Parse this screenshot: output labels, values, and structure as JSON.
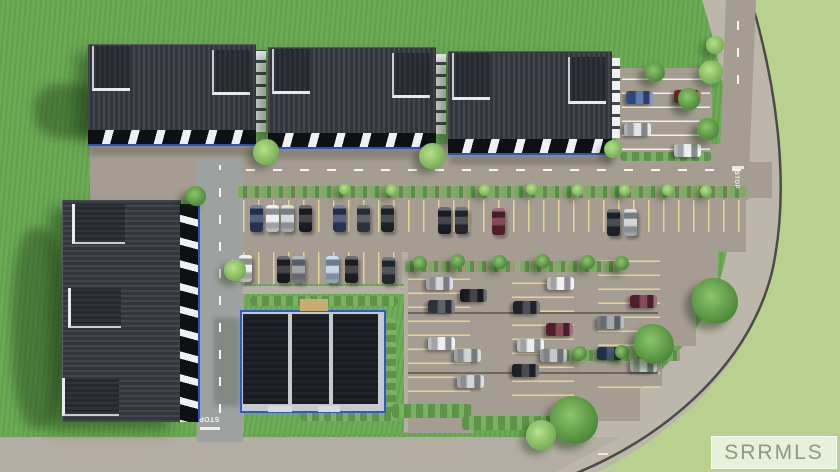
{
  "watermark": {
    "label": "SRRMLS"
  },
  "road_markings": {
    "stop_left": "STOP",
    "stop_right": "STOP"
  },
  "palette": {
    "grass_inner": "#6cab55",
    "grass_outer": "#b8d18f",
    "pavement": "#a69d92",
    "west_road": "#9da19f",
    "south_road": "#b3ada3",
    "perimeter_road": "#bdb6ab",
    "roof_dark": "#3a3e45",
    "panel_black": "#1a1c20",
    "trim_blue": "#3156d2",
    "stall_yellow": "#e4d896",
    "watermark_text": "#8f968c"
  },
  "scene": {
    "els": [
      {
        "n": "building-shadow",
        "c": "gshadow",
        "x": 34,
        "y": 84,
        "w": 70,
        "h": 54
      },
      {
        "n": "building-shadow",
        "c": "gshadow",
        "x": 12,
        "y": 228,
        "w": 54,
        "h": 200
      },
      {
        "n": "facade-shade",
        "c": "shade",
        "x": 90,
        "y": 146,
        "w": 168,
        "h": 10
      },
      {
        "n": "facade-shade",
        "c": "shade",
        "x": 270,
        "y": 149,
        "w": 166,
        "h": 10
      },
      {
        "n": "facade-shade",
        "c": "shade",
        "x": 450,
        "y": 155,
        "w": 162,
        "h": 10
      },
      {
        "n": "building-shade",
        "c": "shade",
        "x": 214,
        "y": 318,
        "w": 26,
        "h": 88
      },
      {
        "n": "stall-row-north",
        "c": "stallv",
        "x": 243,
        "y": 200,
        "w": 500,
        "h": 32
      },
      {
        "n": "stall-row-second",
        "c": "stallv",
        "x": 243,
        "y": 252,
        "w": 162,
        "h": 32
      },
      {
        "n": "stall-col-middle",
        "c": "stallh",
        "x": 408,
        "y": 274,
        "w": 62,
        "h": 118
      },
      {
        "n": "stall-col-middle",
        "c": "stallh",
        "x": 512,
        "y": 274,
        "w": 62,
        "h": 122
      },
      {
        "n": "stall-col-east",
        "c": "stallh",
        "x": 598,
        "y": 258,
        "w": 62,
        "h": 130
      },
      {
        "n": "stall-group-northeast",
        "c": "stallw",
        "x": 622,
        "y": 74,
        "w": 88,
        "h": 76
      },
      {
        "n": "aisle-dash-line",
        "c": "dashh",
        "x": 246,
        "y": 169,
        "w": 496,
        "h": 2
      },
      {
        "n": "west-road-dash-line",
        "c": "dashv",
        "x": 219,
        "y": 165,
        "w": 2,
        "h": 248
      },
      {
        "n": "north-road-dash-line",
        "c": "dashv",
        "x": 737,
        "y": 12,
        "w": 2,
        "h": 72
      },
      {
        "n": "stop-bar-west",
        "c": "box",
        "x": 200,
        "y": 427,
        "w": 20,
        "h": 3,
        "col": "#f0f0ec"
      },
      {
        "n": "stop-bar-north",
        "c": "box",
        "x": 732,
        "y": 166,
        "w": 12,
        "h": 3,
        "col": "#e9e9e4"
      },
      {
        "n": "lane-dot-south-road",
        "c": "box",
        "x": 598,
        "y": 453,
        "w": 10,
        "h": 2,
        "col": "#eceae2"
      },
      {
        "n": "curb-line",
        "c": "curb",
        "x": 408,
        "y": 312,
        "w": 250,
        "h": 2
      },
      {
        "n": "curb-line",
        "c": "curb",
        "x": 408,
        "y": 372,
        "w": 250,
        "h": 2
      },
      {
        "n": "walkway",
        "c": "walk",
        "x": 402,
        "y": 252,
        "w": 6,
        "h": 180
      },
      {
        "n": "planter-strip",
        "c": "strip",
        "x": 238,
        "y": 186,
        "w": 508,
        "h": 12
      },
      {
        "n": "planter-strip",
        "c": "strip",
        "x": 405,
        "y": 261,
        "w": 110,
        "h": 11
      },
      {
        "n": "planter-strip",
        "c": "strip",
        "x": 520,
        "y": 261,
        "w": 100,
        "h": 11
      },
      {
        "n": "planter-strip",
        "c": "strip",
        "x": 560,
        "y": 350,
        "w": 120,
        "h": 11
      },
      {
        "n": "planter-strip",
        "c": "shrub",
        "x": 620,
        "y": 152,
        "w": 92,
        "h": 9
      },
      {
        "n": "lawn-island",
        "c": "island",
        "x": 244,
        "y": 284,
        "w": 160,
        "h": 150
      },
      {
        "n": "walkway",
        "c": "walk",
        "x": 243,
        "y": 286,
        "w": 162,
        "h": 8
      },
      {
        "n": "shrub-row",
        "c": "shrub",
        "x": 250,
        "y": 296,
        "w": 148,
        "h": 10
      },
      {
        "n": "shrub-column",
        "c": "shrubv",
        "x": 382,
        "y": 318,
        "w": 14,
        "h": 96
      },
      {
        "n": "shrub-row",
        "c": "shrub",
        "x": 300,
        "y": 412,
        "w": 96,
        "h": 9
      },
      {
        "n": "shrub-row",
        "c": "shrub",
        "x": 392,
        "y": 404,
        "w": 80,
        "h": 14
      },
      {
        "n": "shrub-row",
        "c": "shrub",
        "x": 462,
        "y": 416,
        "w": 100,
        "h": 14
      },
      {
        "n": "clubhouse-base",
        "c": "trim",
        "x": 240,
        "y": 310,
        "w": 142,
        "h": 99
      },
      {
        "n": "clubhouse-roof-panel",
        "c": "panel",
        "x": 243,
        "y": 314,
        "w": 45,
        "h": 90
      },
      {
        "n": "clubhouse-roof-panel",
        "c": "panel",
        "x": 292,
        "y": 314,
        "w": 37,
        "h": 90
      },
      {
        "n": "clubhouse-roof-panel",
        "c": "panel",
        "x": 333,
        "y": 314,
        "w": 45,
        "h": 90
      },
      {
        "n": "clubhouse-entry",
        "c": "box",
        "x": 300,
        "y": 299,
        "w": 28,
        "h": 12,
        "col": "#c6ae72"
      },
      {
        "n": "clubhouse-step",
        "c": "box",
        "x": 268,
        "y": 406,
        "w": 24,
        "h": 6,
        "col": "#d9dbdd"
      },
      {
        "n": "clubhouse-step",
        "c": "box",
        "x": 318,
        "y": 406,
        "w": 22,
        "h": 6,
        "col": "#d9dbdd"
      },
      {
        "n": "rowhouse-roof-1",
        "c": "roofh",
        "x": 88,
        "y": 44,
        "w": 168,
        "h": 86
      },
      {
        "n": "rowhouse-facade-1",
        "c": "facadeh",
        "x": 88,
        "y": 130,
        "w": 168,
        "h": 14
      },
      {
        "n": "dormer",
        "c": "dormh",
        "x": 92,
        "y": 46,
        "w": 36,
        "h": 42
      },
      {
        "n": "dormer",
        "c": "dormh",
        "x": 212,
        "y": 50,
        "w": 36,
        "h": 42
      },
      {
        "n": "end-wall",
        "c": "endwall",
        "x": 256,
        "y": 50,
        "w": 10,
        "h": 82
      },
      {
        "n": "rowhouse-roof-2",
        "c": "roofh",
        "x": 268,
        "y": 47,
        "w": 168,
        "h": 86
      },
      {
        "n": "rowhouse-facade-2",
        "c": "facadeh",
        "x": 268,
        "y": 133,
        "w": 168,
        "h": 14
      },
      {
        "n": "dormer",
        "c": "dormh",
        "x": 272,
        "y": 49,
        "w": 36,
        "h": 42
      },
      {
        "n": "dormer",
        "c": "dormh",
        "x": 392,
        "y": 53,
        "w": 36,
        "h": 42
      },
      {
        "n": "end-wall",
        "c": "endwall",
        "x": 436,
        "y": 54,
        "w": 10,
        "h": 80
      },
      {
        "n": "rowhouse-roof-3",
        "c": "roofh",
        "x": 448,
        "y": 51,
        "w": 164,
        "h": 88
      },
      {
        "n": "rowhouse-facade-3",
        "c": "facadeh",
        "x": 448,
        "y": 139,
        "w": 164,
        "h": 14
      },
      {
        "n": "dormer",
        "c": "dormh",
        "x": 452,
        "y": 53,
        "w": 36,
        "h": 44
      },
      {
        "n": "dormer",
        "c": "dormh",
        "x": 568,
        "y": 57,
        "w": 36,
        "h": 44
      },
      {
        "n": "end-wall",
        "c": "endwall",
        "x": 612,
        "y": 58,
        "w": 8,
        "h": 80
      },
      {
        "n": "rowhouse-roof-west",
        "c": "roofv",
        "x": 62,
        "y": 200,
        "w": 118,
        "h": 222
      },
      {
        "n": "rowhouse-facade-west",
        "c": "facadev",
        "x": 180,
        "y": 204,
        "w": 18,
        "h": 218
      },
      {
        "n": "dormer",
        "c": "dormv",
        "x": 72,
        "y": 204,
        "w": 50,
        "h": 38
      },
      {
        "n": "dormer",
        "c": "dormv",
        "x": 68,
        "y": 288,
        "w": 50,
        "h": 38
      },
      {
        "n": "dormer",
        "c": "dormv",
        "x": 62,
        "y": 378,
        "w": 54,
        "h": 36
      },
      {
        "n": "parked-car",
        "c": "car",
        "x": 250,
        "y": 205,
        "w": 13,
        "h": 27,
        "col": "#2e3f66"
      },
      {
        "n": "parked-car",
        "c": "car",
        "x": 266,
        "y": 205,
        "w": 13,
        "h": 27,
        "col": "#e9eaeb"
      },
      {
        "n": "parked-car",
        "c": "car",
        "x": 281,
        "y": 205,
        "w": 13,
        "h": 27,
        "col": "#ccd0d2"
      },
      {
        "n": "parked-car",
        "c": "car",
        "x": 299,
        "y": 205,
        "w": 13,
        "h": 27,
        "col": "#1c1e22"
      },
      {
        "n": "parked-car",
        "c": "car",
        "x": 333,
        "y": 205,
        "w": 13,
        "h": 27,
        "col": "#31406b"
      },
      {
        "n": "parked-car",
        "c": "car",
        "x": 357,
        "y": 205,
        "w": 13,
        "h": 27,
        "col": "#3a3e45"
      },
      {
        "n": "parked-car",
        "c": "car",
        "x": 381,
        "y": 205,
        "w": 13,
        "h": 27,
        "col": "#22252a"
      },
      {
        "n": "parked-car",
        "c": "car",
        "x": 438,
        "y": 207,
        "w": 13,
        "h": 27,
        "col": "#1c1f24"
      },
      {
        "n": "parked-car",
        "c": "car",
        "x": 455,
        "y": 207,
        "w": 13,
        "h": 27,
        "col": "#2a2d33"
      },
      {
        "n": "parked-car",
        "c": "car",
        "x": 492,
        "y": 208,
        "w": 13,
        "h": 27,
        "col": "#6b2330"
      },
      {
        "n": "parked-car",
        "c": "car",
        "x": 607,
        "y": 209,
        "w": 13,
        "h": 27,
        "col": "#23262b"
      },
      {
        "n": "parked-car",
        "c": "car",
        "x": 624,
        "y": 209,
        "w": 13,
        "h": 27,
        "col": "#c9cccd"
      },
      {
        "n": "parked-car",
        "c": "car",
        "x": 239,
        "y": 255,
        "w": 13,
        "h": 27,
        "col": "#e9eaeb"
      },
      {
        "n": "parked-car",
        "c": "car",
        "x": 277,
        "y": 256,
        "w": 13,
        "h": 27,
        "col": "#1b1d21"
      },
      {
        "n": "parked-car",
        "c": "car",
        "x": 292,
        "y": 256,
        "w": 13,
        "h": 27,
        "col": "#8e9296"
      },
      {
        "n": "parked-car",
        "c": "car",
        "x": 326,
        "y": 256,
        "w": 13,
        "h": 27,
        "col": "#b9cde2"
      },
      {
        "n": "parked-car",
        "c": "car",
        "x": 345,
        "y": 256,
        "w": 13,
        "h": 27,
        "col": "#1d2025"
      },
      {
        "n": "parked-car",
        "c": "car",
        "x": 382,
        "y": 257,
        "w": 13,
        "h": 27,
        "col": "#2c2f35"
      },
      {
        "n": "parked-car",
        "c": "car",
        "x": 633,
        "y": 84,
        "w": 13,
        "h": 27,
        "r": 90,
        "col": "#3a5fa0"
      },
      {
        "n": "parked-car",
        "c": "car",
        "x": 681,
        "y": 83,
        "w": 13,
        "h": 27,
        "r": 90,
        "col": "#8d2f2f"
      },
      {
        "n": "parked-car",
        "c": "car",
        "x": 631,
        "y": 116,
        "w": 13,
        "h": 27,
        "r": 90,
        "col": "#dcdedf"
      },
      {
        "n": "parked-car",
        "c": "car",
        "x": 681,
        "y": 137,
        "w": 13,
        "h": 27,
        "r": 90,
        "col": "#e9eaeb"
      },
      {
        "n": "parked-car",
        "c": "car",
        "x": 433,
        "y": 270,
        "w": 13,
        "h": 27,
        "r": 90,
        "col": "#caccce"
      },
      {
        "n": "parked-car",
        "c": "car",
        "x": 467,
        "y": 282,
        "w": 13,
        "h": 27,
        "r": 90,
        "col": "#1b1e22"
      },
      {
        "n": "parked-car",
        "c": "car",
        "x": 435,
        "y": 293,
        "w": 13,
        "h": 27,
        "r": 90,
        "col": "#3c4046"
      },
      {
        "n": "parked-car",
        "c": "car",
        "x": 554,
        "y": 270,
        "w": 13,
        "h": 27,
        "r": 90,
        "col": "#eceded"
      },
      {
        "n": "parked-car",
        "c": "car",
        "x": 520,
        "y": 294,
        "w": 13,
        "h": 27,
        "r": 90,
        "col": "#26292e"
      },
      {
        "n": "parked-car",
        "c": "car",
        "x": 553,
        "y": 316,
        "w": 13,
        "h": 27,
        "r": 90,
        "col": "#6e2430"
      },
      {
        "n": "parked-car",
        "c": "car",
        "x": 604,
        "y": 309,
        "w": 13,
        "h": 27,
        "r": 90,
        "col": "#94989b"
      },
      {
        "n": "parked-car",
        "c": "car",
        "x": 524,
        "y": 332,
        "w": 13,
        "h": 27,
        "r": 90,
        "col": "#e9eaeb"
      },
      {
        "n": "parked-car",
        "c": "car",
        "x": 547,
        "y": 342,
        "w": 13,
        "h": 27,
        "r": 90,
        "col": "#b9bcbe"
      },
      {
        "n": "parked-car",
        "c": "car",
        "x": 435,
        "y": 330,
        "w": 13,
        "h": 27,
        "r": 90,
        "col": "#eaebec"
      },
      {
        "n": "parked-car",
        "c": "car",
        "x": 461,
        "y": 342,
        "w": 13,
        "h": 27,
        "r": 90,
        "col": "#c7cacb"
      },
      {
        "n": "parked-car",
        "c": "car",
        "x": 519,
        "y": 357,
        "w": 13,
        "h": 27,
        "r": 90,
        "col": "#23262b"
      },
      {
        "n": "parked-car",
        "c": "car",
        "x": 464,
        "y": 368,
        "w": 13,
        "h": 27,
        "r": 90,
        "col": "#cbcecf"
      },
      {
        "n": "parked-car",
        "c": "car",
        "x": 604,
        "y": 340,
        "w": 13,
        "h": 27,
        "r": 90,
        "col": "#2b3a5e"
      },
      {
        "n": "parked-car",
        "c": "car",
        "x": 637,
        "y": 288,
        "w": 13,
        "h": 27,
        "r": 90,
        "col": "#6e2430"
      },
      {
        "n": "parked-car",
        "c": "car",
        "x": 637,
        "y": 352,
        "w": 13,
        "h": 27,
        "r": 90,
        "col": "#c9cccd"
      },
      {
        "n": "tree",
        "c": "treeL",
        "x": 253,
        "y": 139,
        "w": 26,
        "h": 26
      },
      {
        "n": "tree",
        "c": "treeL",
        "x": 419,
        "y": 143,
        "w": 26,
        "h": 26
      },
      {
        "n": "tree",
        "c": "tree",
        "x": 645,
        "y": 62,
        "w": 20,
        "h": 20
      },
      {
        "n": "tree",
        "c": "tree",
        "x": 678,
        "y": 88,
        "w": 22,
        "h": 22
      },
      {
        "n": "tree",
        "c": "treeL",
        "x": 604,
        "y": 140,
        "w": 18,
        "h": 18
      },
      {
        "n": "tree",
        "c": "treeL",
        "x": 699,
        "y": 60,
        "w": 24,
        "h": 24
      },
      {
        "n": "tree",
        "c": "tree",
        "x": 697,
        "y": 118,
        "w": 22,
        "h": 22
      },
      {
        "n": "tree",
        "c": "treeL",
        "x": 706,
        "y": 36,
        "w": 18,
        "h": 18
      },
      {
        "n": "tree",
        "c": "treeL",
        "x": 224,
        "y": 259,
        "w": 22,
        "h": 22
      },
      {
        "n": "tree",
        "c": "tree",
        "x": 186,
        "y": 186,
        "w": 20,
        "h": 20
      },
      {
        "n": "tree",
        "c": "treeL",
        "x": 339,
        "y": 183,
        "w": 12,
        "h": 12
      },
      {
        "n": "tree",
        "c": "treeL",
        "x": 386,
        "y": 184,
        "w": 12,
        "h": 12
      },
      {
        "n": "tree",
        "c": "treeL",
        "x": 479,
        "y": 184,
        "w": 12,
        "h": 12
      },
      {
        "n": "tree",
        "c": "treeL",
        "x": 526,
        "y": 183,
        "w": 12,
        "h": 12
      },
      {
        "n": "tree",
        "c": "treeL",
        "x": 572,
        "y": 184,
        "w": 12,
        "h": 12
      },
      {
        "n": "tree",
        "c": "treeL",
        "x": 619,
        "y": 184,
        "w": 12,
        "h": 12
      },
      {
        "n": "tree",
        "c": "treeL",
        "x": 662,
        "y": 184,
        "w": 12,
        "h": 12
      },
      {
        "n": "tree",
        "c": "treeL",
        "x": 700,
        "y": 185,
        "w": 12,
        "h": 12
      },
      {
        "n": "tree",
        "c": "tree",
        "x": 413,
        "y": 256,
        "w": 14,
        "h": 14
      },
      {
        "n": "tree",
        "c": "tree",
        "x": 451,
        "y": 254,
        "w": 14,
        "h": 14
      },
      {
        "n": "tree",
        "c": "tree",
        "x": 493,
        "y": 255,
        "w": 14,
        "h": 14
      },
      {
        "n": "tree",
        "c": "tree",
        "x": 536,
        "y": 254,
        "w": 14,
        "h": 14
      },
      {
        "n": "tree",
        "c": "tree",
        "x": 581,
        "y": 255,
        "w": 14,
        "h": 14
      },
      {
        "n": "tree",
        "c": "tree",
        "x": 615,
        "y": 256,
        "w": 14,
        "h": 14
      },
      {
        "n": "tree",
        "c": "tree",
        "x": 573,
        "y": 346,
        "w": 14,
        "h": 14
      },
      {
        "n": "tree",
        "c": "tree",
        "x": 615,
        "y": 345,
        "w": 14,
        "h": 14
      },
      {
        "n": "tree",
        "c": "tree",
        "x": 653,
        "y": 344,
        "w": 14,
        "h": 14
      },
      {
        "n": "tree",
        "c": "tree",
        "x": 692,
        "y": 278,
        "w": 46,
        "h": 46
      },
      {
        "n": "tree",
        "c": "tree",
        "x": 634,
        "y": 324,
        "w": 40,
        "h": 40
      },
      {
        "n": "tree",
        "c": "tree",
        "x": 550,
        "y": 396,
        "w": 48,
        "h": 48
      },
      {
        "n": "tree",
        "c": "treeL",
        "x": 526,
        "y": 420,
        "w": 30,
        "h": 30
      }
    ]
  }
}
